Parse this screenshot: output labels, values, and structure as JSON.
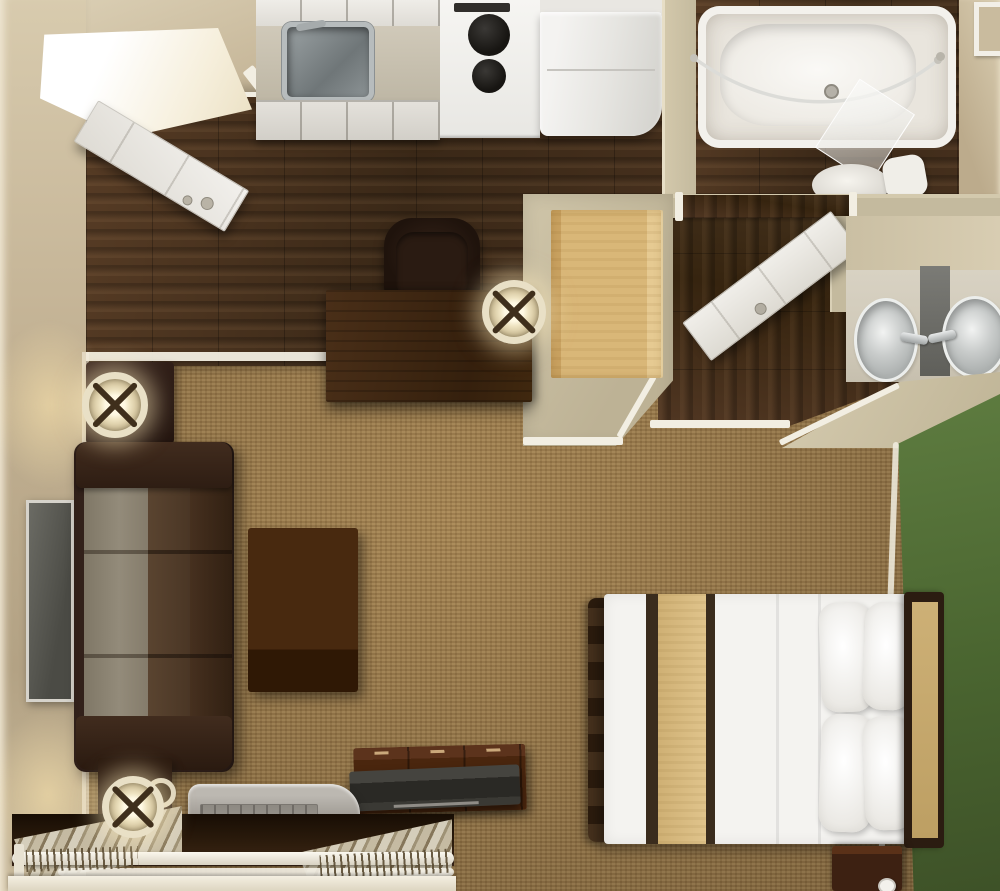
{
  "scene": {
    "kind": "3d-rendered floor plan, top-down cutaway view",
    "subject": "Studio apartment / extended-stay suite with kitchen, bathroom, dressing vanity, living area, bed and open closet",
    "text_visible": "none"
  },
  "palette": {
    "carpet": "#9c7b4b",
    "wood": "#3a2817",
    "beige": "#c4b496",
    "khaki": "#c4ba9e",
    "trim": "#f2eee2",
    "cabinet": "#dcd9d2",
    "counter": "#bdb6a4",
    "appliance": "#f6f5f2",
    "tub": "#f3f1ec",
    "porcelain": "#d9d6cf",
    "sink": "#c9cccb",
    "mirror": "#5f5f5a",
    "bench": "#d9b778",
    "door": "#f0eee9",
    "green": "#4a6530",
    "sofa_frame": "#32211a",
    "sofa_cushion": "#938b7a",
    "table": "#48290f",
    "desk": "#35200d",
    "chair": "#1f130c",
    "bed": "#f4f3f0",
    "bed_tan": "#e0c48c",
    "bed_dark": "#3a2c1d",
    "headboard": "#cdb076",
    "headboard_frame": "#2b1c11",
    "dresser": "#4a260e",
    "tv": "#4b4b45",
    "ac": "#a09c95",
    "lamp": "#e9e0c6"
  },
  "rooms": [
    {
      "id": "entry",
      "label": "Entry with open door"
    },
    {
      "id": "kitchen",
      "label": "Kitchen along top wall"
    },
    {
      "id": "office",
      "label": "Work area with desk and chair"
    },
    {
      "id": "bathroom",
      "label": "Bathroom with tub and toilet"
    },
    {
      "id": "dressing",
      "label": "Dressing corridor with twin-sink vanity"
    },
    {
      "id": "living",
      "label": "Living area with sofa and wall TV"
    },
    {
      "id": "sleeping",
      "label": "Sleeping area with double bed"
    },
    {
      "id": "closet",
      "label": "Open closet with hanger rod"
    }
  ],
  "furniture": {
    "entry_door": {
      "label": "Entry door (open)"
    },
    "upper_cabinets": {
      "label": "Kitchen upper cabinets"
    },
    "lower_cabinets": {
      "label": "Kitchen lower cabinets"
    },
    "kitchen_sink": {
      "label": "Stainless kitchen sink"
    },
    "kitchen_faucet": {
      "label": "Kitchen faucet"
    },
    "stove": {
      "label": "Two-burner stove"
    },
    "microwave": {
      "label": "Microwave vent slot"
    },
    "refrigerator": {
      "label": "Refrigerator"
    },
    "bathtub": {
      "label": "Bathtub"
    },
    "shower_rod": {
      "label": "Curved shower rod"
    },
    "shower_glass": {
      "label": "Glass splash panel"
    },
    "toilet": {
      "label": "Toilet"
    },
    "picture_frame": {
      "label": "Framed mirror on top wall"
    },
    "interior_door": {
      "label": "Bathroom door (open)"
    },
    "bench_counter": {
      "label": "Counter / luggage bench"
    },
    "vanity_sinks": {
      "label": "Vanity twin sinks with mirror"
    },
    "faucet": {
      "label": "Chrome faucet"
    },
    "desk": {
      "label": "Writing desk"
    },
    "desk_chair": {
      "label": "Desk chair"
    },
    "desk_lamp": {
      "label": "Desk lamp"
    },
    "wall_tv": {
      "label": "Wall-mounted TV"
    },
    "end_table": {
      "label": "End table"
    },
    "floor_lamp": {
      "label": "Floor lamp"
    },
    "sofa": {
      "label": "Sofa with taupe cushions"
    },
    "coffee_table": {
      "label": "Coffee table"
    },
    "side_table": {
      "label": "Lamp table"
    },
    "table_lamp": {
      "label": "Table lamp"
    },
    "ac_unit": {
      "label": "PTAC air-conditioner"
    },
    "dresser": {
      "label": "Dresser"
    },
    "dresser_tv": {
      "label": "Flat-screen TV on dresser"
    },
    "closet_rod": {
      "label": "Closet rod"
    },
    "hangers": {
      "label": "Hangers"
    },
    "linens": {
      "label": "Folded linens"
    },
    "bed": {
      "label": "Double bed with white duvet"
    },
    "pillows": {
      "label": "Pillow"
    },
    "headboard": {
      "label": "Headboard"
    },
    "nightstand": {
      "label": "Nightstand"
    },
    "cup": {
      "label": "Cup"
    },
    "green_wall": {
      "label": "Green accent wall"
    }
  }
}
